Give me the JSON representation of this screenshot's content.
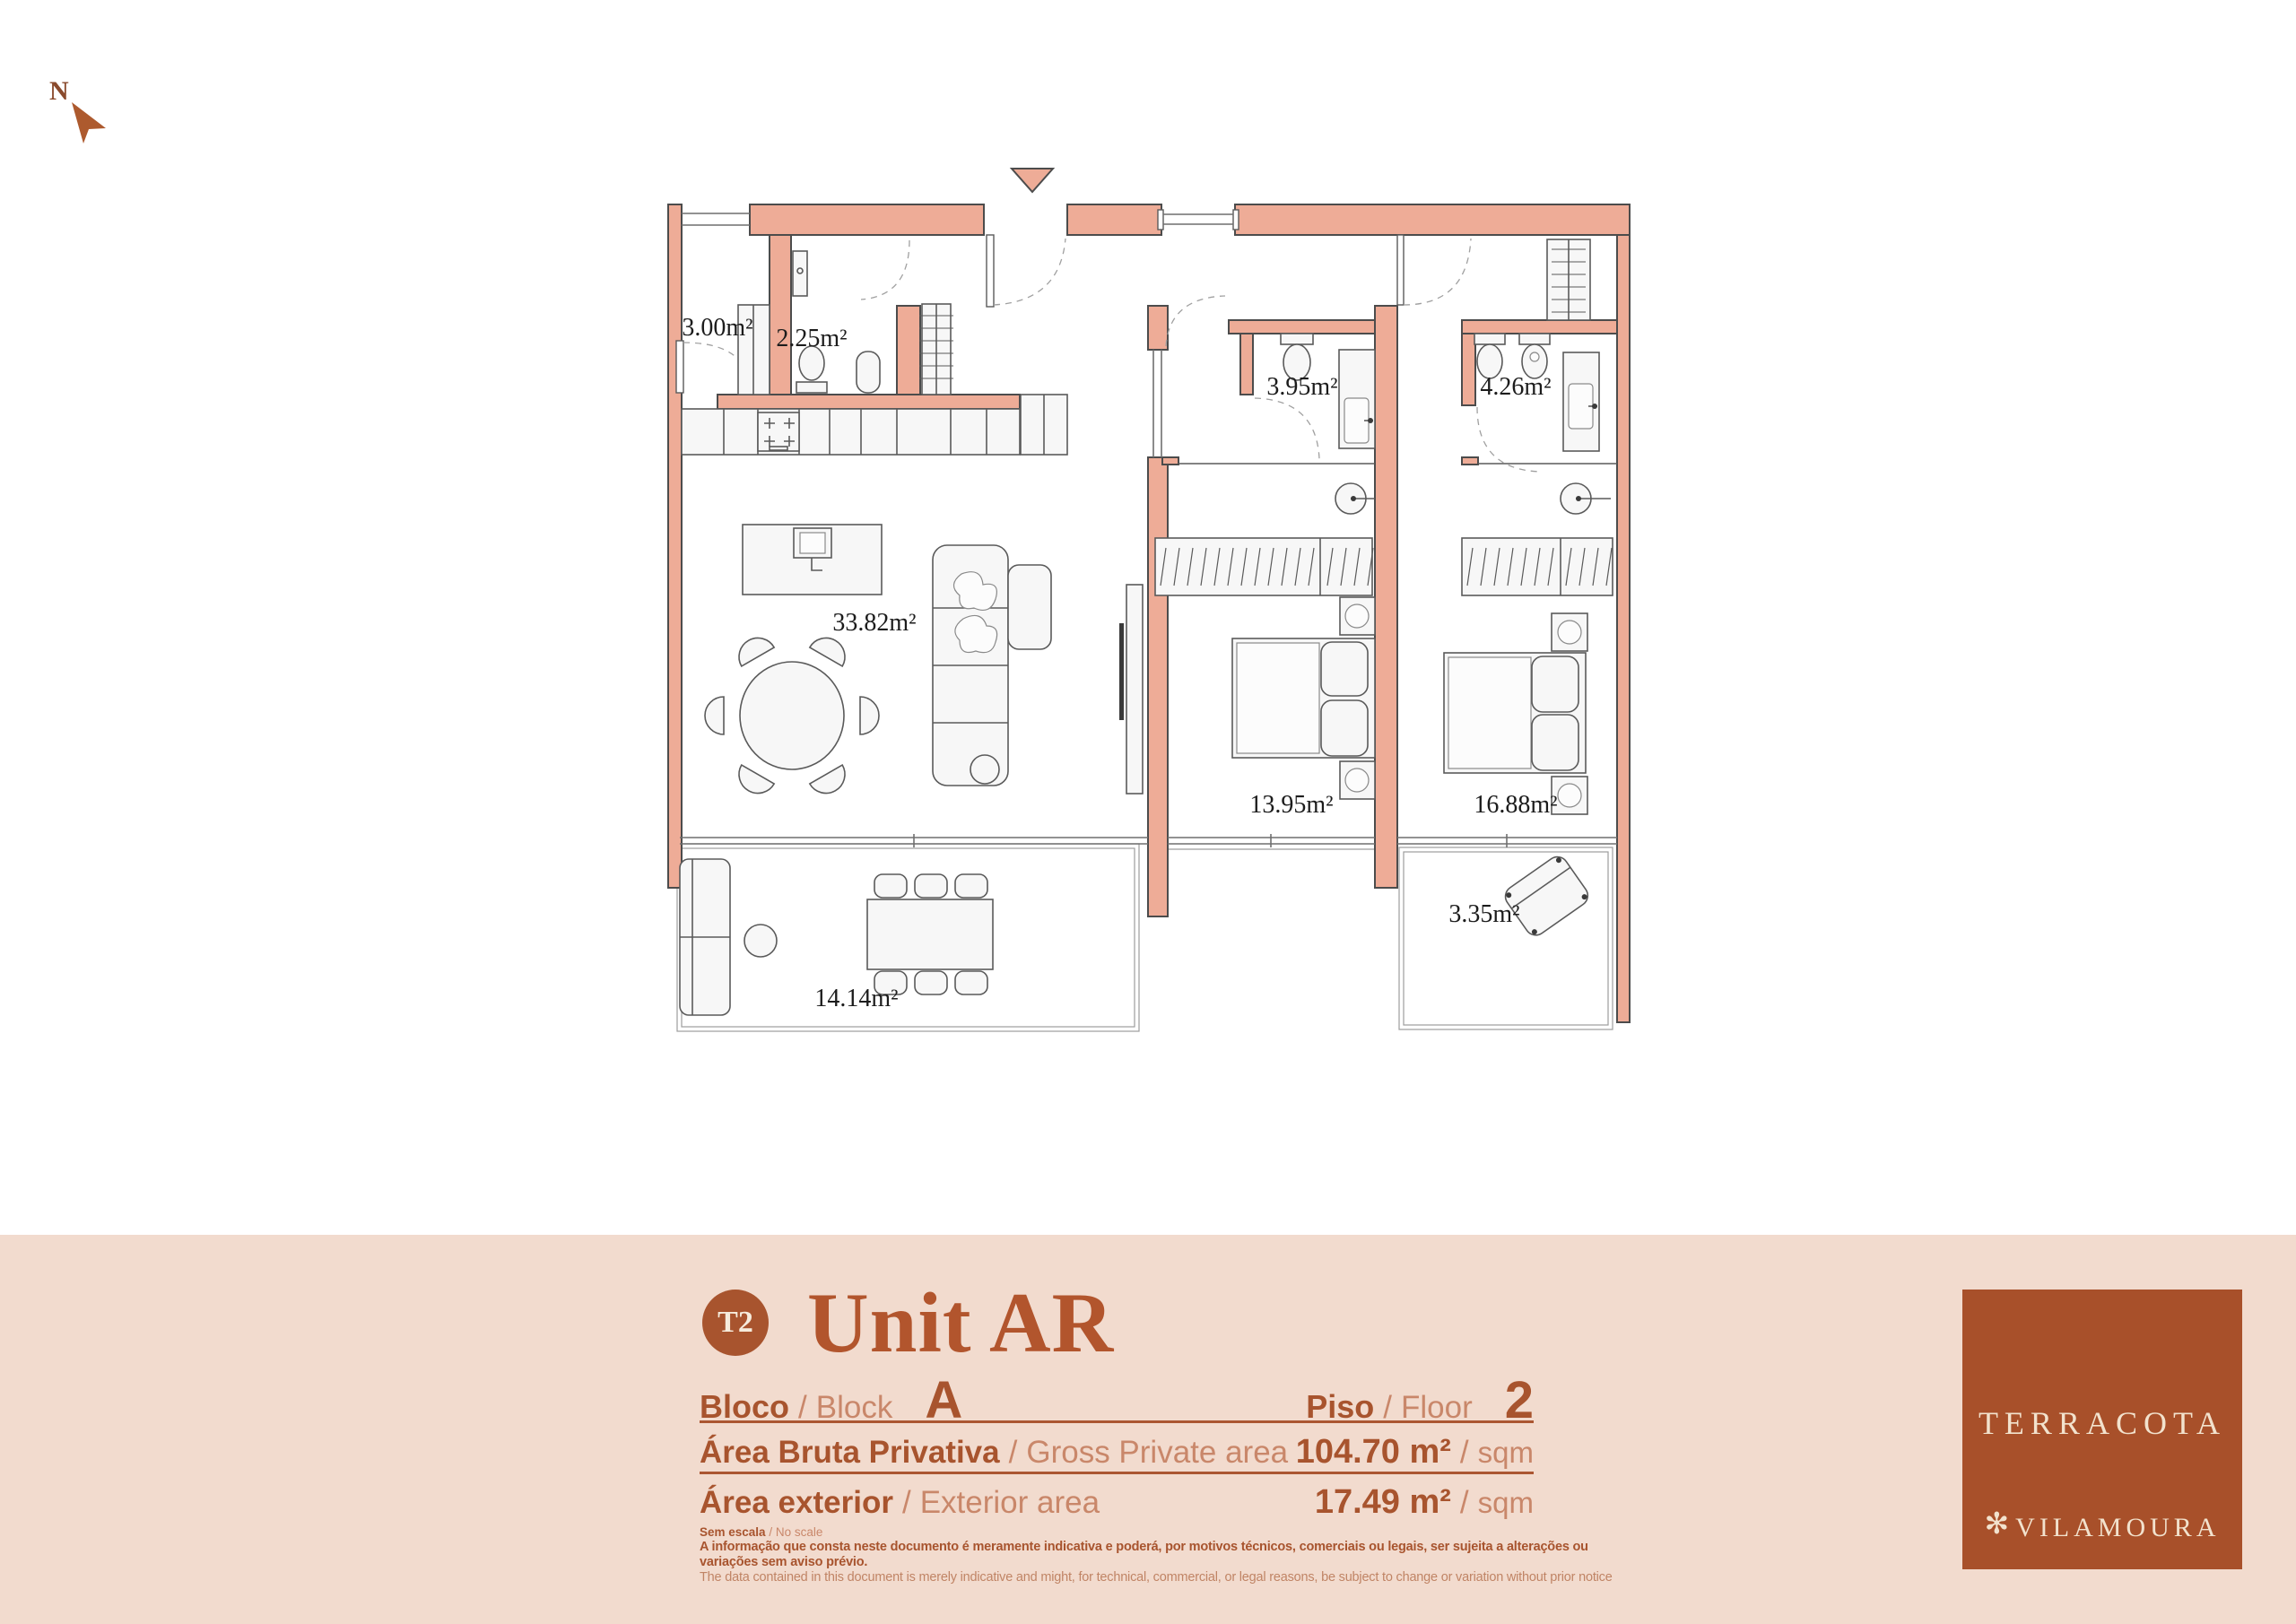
{
  "page": {
    "north_label": "N"
  },
  "floor_plan": {
    "rooms": {
      "storage": {
        "area": "3.00m²"
      },
      "wc": {
        "area": "2.25m²"
      },
      "bathroom_1": {
        "area": "3.95m²"
      },
      "bathroom_2": {
        "area": "4.26m²"
      },
      "living_dining": {
        "area": "33.82m²"
      },
      "bedroom_1": {
        "area": "13.95m²"
      },
      "bedroom_2": {
        "area": "16.88m²"
      },
      "balcony": {
        "area": "3.35m²"
      },
      "terrace": {
        "area": "14.14m²"
      }
    }
  },
  "site_plan": {
    "north_label": "N",
    "block_a": "A",
    "block_b": "B",
    "block_c": "C"
  },
  "info": {
    "typology_badge": "T2",
    "title": "Unit AR",
    "sep": "/",
    "block": {
      "label_pt": "Bloco",
      "label_en": "Block",
      "value": "A"
    },
    "floor": {
      "label_pt": "Piso",
      "label_en": "Floor",
      "value": "2"
    },
    "gross_area": {
      "label_pt": "Área Bruta Privativa",
      "label_en": "Gross Private area",
      "value": "104.70 m²",
      "unit": "sqm"
    },
    "exterior_area": {
      "label_pt": "Área exterior",
      "label_en": "Exterior area",
      "value": "17.49 m²",
      "unit": "sqm"
    },
    "scale_note": {
      "label_pt": "Sem escala",
      "label_en": "No scale"
    },
    "disclaimer_pt": "A informação que consta neste documento é meramente indicativa e poderá, por motivos técnicos, comerciais ou legais, ser sujeita a alterações ou variações sem aviso prévio.",
    "disclaimer_en": "The data contained in this document is merely indicative and might, for technical, commercial, or legal reasons, be subject to change or variation without prior notice"
  },
  "logo": {
    "mark": "✻",
    "brand": "TERRACOTA",
    "location": "VILAMOURA"
  },
  "colors": {
    "accent": "#a8542e",
    "wall": "#eeac97",
    "panel_bg": "#f2dbce",
    "logo_bg": "#a8502a",
    "highlight_unit": "#b4542c"
  }
}
